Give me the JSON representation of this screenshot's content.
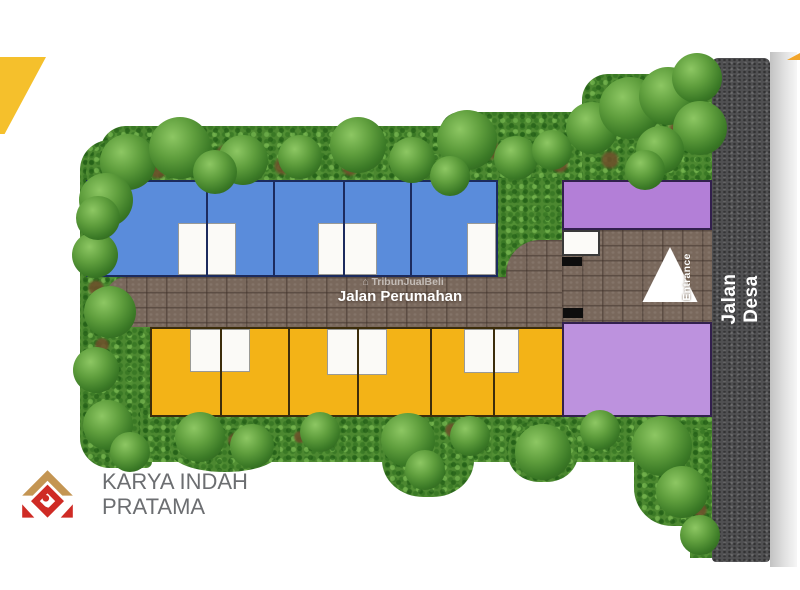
{
  "plan": {
    "branding": {
      "line1": "KARYA INDAH",
      "line2": "PRATAMA"
    },
    "roads": {
      "internal": "Jalan Perumahan",
      "main": "Jalan Desa"
    },
    "watermark": {
      "icon": "⌂",
      "text": "TribunJualBeli"
    },
    "entrance": {
      "arrow_label": "Entrance",
      "guard_post": "Pos\nSatpam"
    },
    "facilities": {
      "social": "Fasilitas\nSosial",
      "public": "Fasilitas\nUmum"
    },
    "housing_rows": {
      "row_b": {
        "lots": [
          "B5",
          "B4",
          "B3",
          "B2",
          "B1"
        ],
        "color": "#5A8CDB"
      },
      "row_c": {
        "lots": [
          "C6",
          "C5",
          "C4",
          "C3",
          "C2",
          "C1"
        ],
        "color": "#F3B317"
      }
    },
    "ruko": {
      "a3": "Ruko\nA3",
      "a2": "Ruko\nA2",
      "a1": "Ruko\nA1",
      "color": "#B586D9"
    },
    "palette": {
      "road_internal": "#79685C",
      "road_main": "#505052",
      "landscape_green": "#4C8830",
      "logo_red": "#CF2B25",
      "logo_gold": "#C49552",
      "accent_wedge": "#F5C02C",
      "label_navy": "#132F7C",
      "label_brown": "#3F2F08"
    }
  }
}
